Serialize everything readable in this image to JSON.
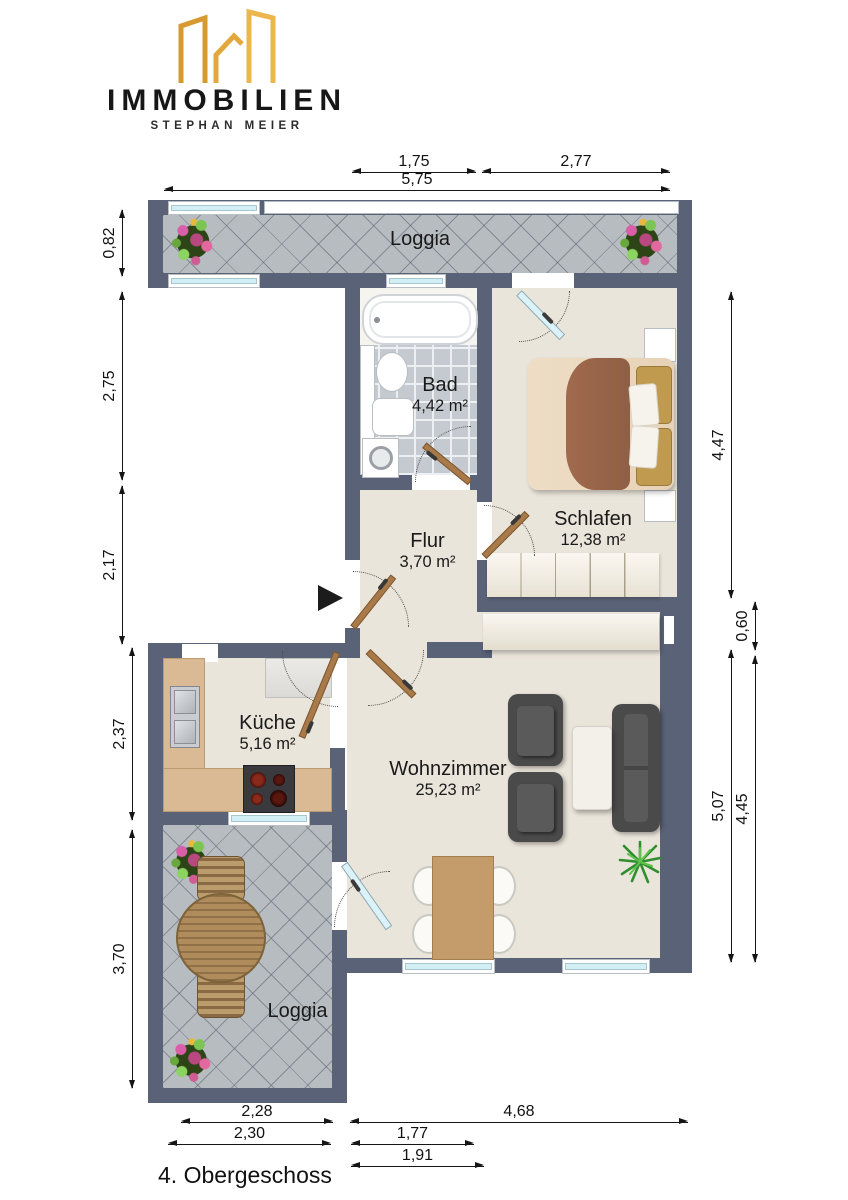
{
  "logo": {
    "brand": "IMMOBILIEN",
    "subtitle": "STEPHAN MEIER",
    "accent_color": "#E2A33C"
  },
  "floor_label": "4. Obergeschoss",
  "rooms": {
    "loggia_top": {
      "name": "Loggia",
      "area": ""
    },
    "bad": {
      "name": "Bad",
      "area": "4,42 m²"
    },
    "schlafen": {
      "name": "Schlafen",
      "area": "12,38 m²"
    },
    "flur": {
      "name": "Flur",
      "area": "3,70 m²"
    },
    "kueche": {
      "name": "Küche",
      "area": "5,16 m²"
    },
    "wohnzimmer": {
      "name": "Wohnzimmer",
      "area": "25,23 m²"
    },
    "loggia_bottom": {
      "name": "Loggia",
      "area": ""
    }
  },
  "dims": {
    "top": [
      "1,75",
      "2,77",
      "5,75"
    ],
    "left": [
      "0,82",
      "2,75",
      "2,17",
      "2,37",
      "3,70"
    ],
    "right": [
      "4,47",
      "0,60",
      "5,07",
      "4,45"
    ],
    "bottom": [
      "2,28",
      "2,30",
      "4,68",
      "1,77",
      "1,91"
    ]
  },
  "icons": {
    "entrance": "right-arrow",
    "plant": "starburst-plant",
    "flowers": "flower-cluster"
  },
  "colors": {
    "wall": "#5a6278",
    "floor": "#eae5da",
    "loggia_tile": "#b7bcc1",
    "bath_tile": "#c5cad0",
    "window_glass": "#d2eff6",
    "door_wood": "#a87a4a",
    "logo_gold": "#E2A33C"
  }
}
